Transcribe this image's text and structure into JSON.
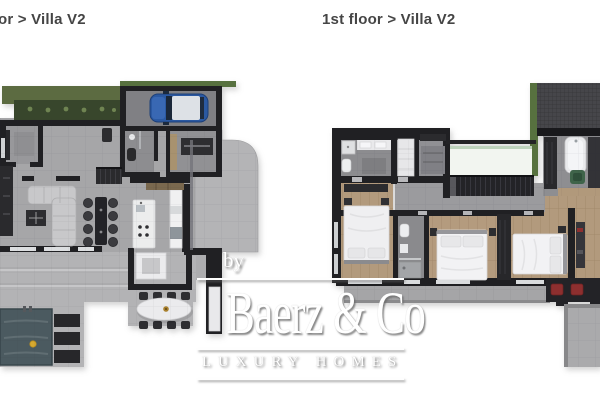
{
  "page": {
    "width": 600,
    "height": 400,
    "background": "#ffffff"
  },
  "header": {
    "left_plan_label": "or > Villa V2",
    "right_plan_label": "1st floor > Villa V2"
  },
  "watermark": {
    "prefix": "by",
    "brand": "Baerz & Co",
    "tagline": "LUXURY HOMES"
  },
  "plans": {
    "ground_floor": {
      "rooms": [
        "garden planter",
        "carport",
        "entry room",
        "bathroom",
        "utility room",
        "living room",
        "dining area",
        "kitchen",
        "staircase",
        "terrace",
        "outdoor dining",
        "pool"
      ]
    },
    "first_floor": {
      "rooms": [
        "bathroom",
        "wardrobe room",
        "laundry room",
        "void with glass rail",
        "staircase",
        "hallway",
        "bedroom 1",
        "en-suite bathroom",
        "bedroom 2",
        "bedroom 3",
        "master bathroom",
        "study",
        "balcony",
        "roof terrace",
        "green roof edge"
      ]
    }
  },
  "colors": {
    "title_text": "#454545",
    "wall": "#202023",
    "concrete_floor": "#a6a6a8",
    "terrace_floor": "#b3b3b5",
    "wood_floor": "#b29a7d",
    "garden_green": "#5c6b41",
    "planter_green": "#38462c",
    "roof_green": "#57713f",
    "pool_water": "#4b5a60",
    "car_blue": "#2b59a2",
    "accent_red": "#8d2f2f",
    "chair_green": "#3f644a",
    "float_yellow": "#d6a930",
    "watermark_white": "#ffffff"
  }
}
